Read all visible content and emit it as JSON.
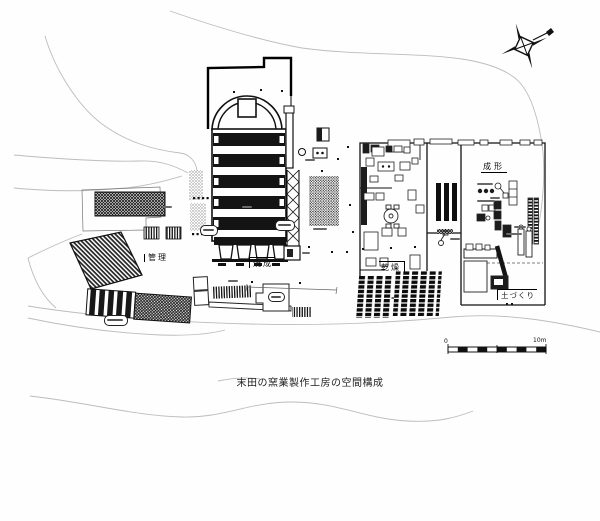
{
  "diagram": {
    "caption": "末田の窯業製作工房の空間構成",
    "area_labels": {
      "firing": "焼成",
      "drying": "乾燥",
      "forming": "成形",
      "clay_making": "土づくり",
      "management": "管理"
    },
    "scale_bar": {
      "start_label": "0",
      "end_label": "10m",
      "segments": 10
    },
    "icons": {
      "compass": "north-compass-icon",
      "kiln": "climbing-kiln-plan",
      "chimney": "chimney-truss"
    },
    "colors": {
      "ink": "#111111",
      "terrain_line": "#bcbcbc",
      "paper": "#ffffff"
    }
  }
}
